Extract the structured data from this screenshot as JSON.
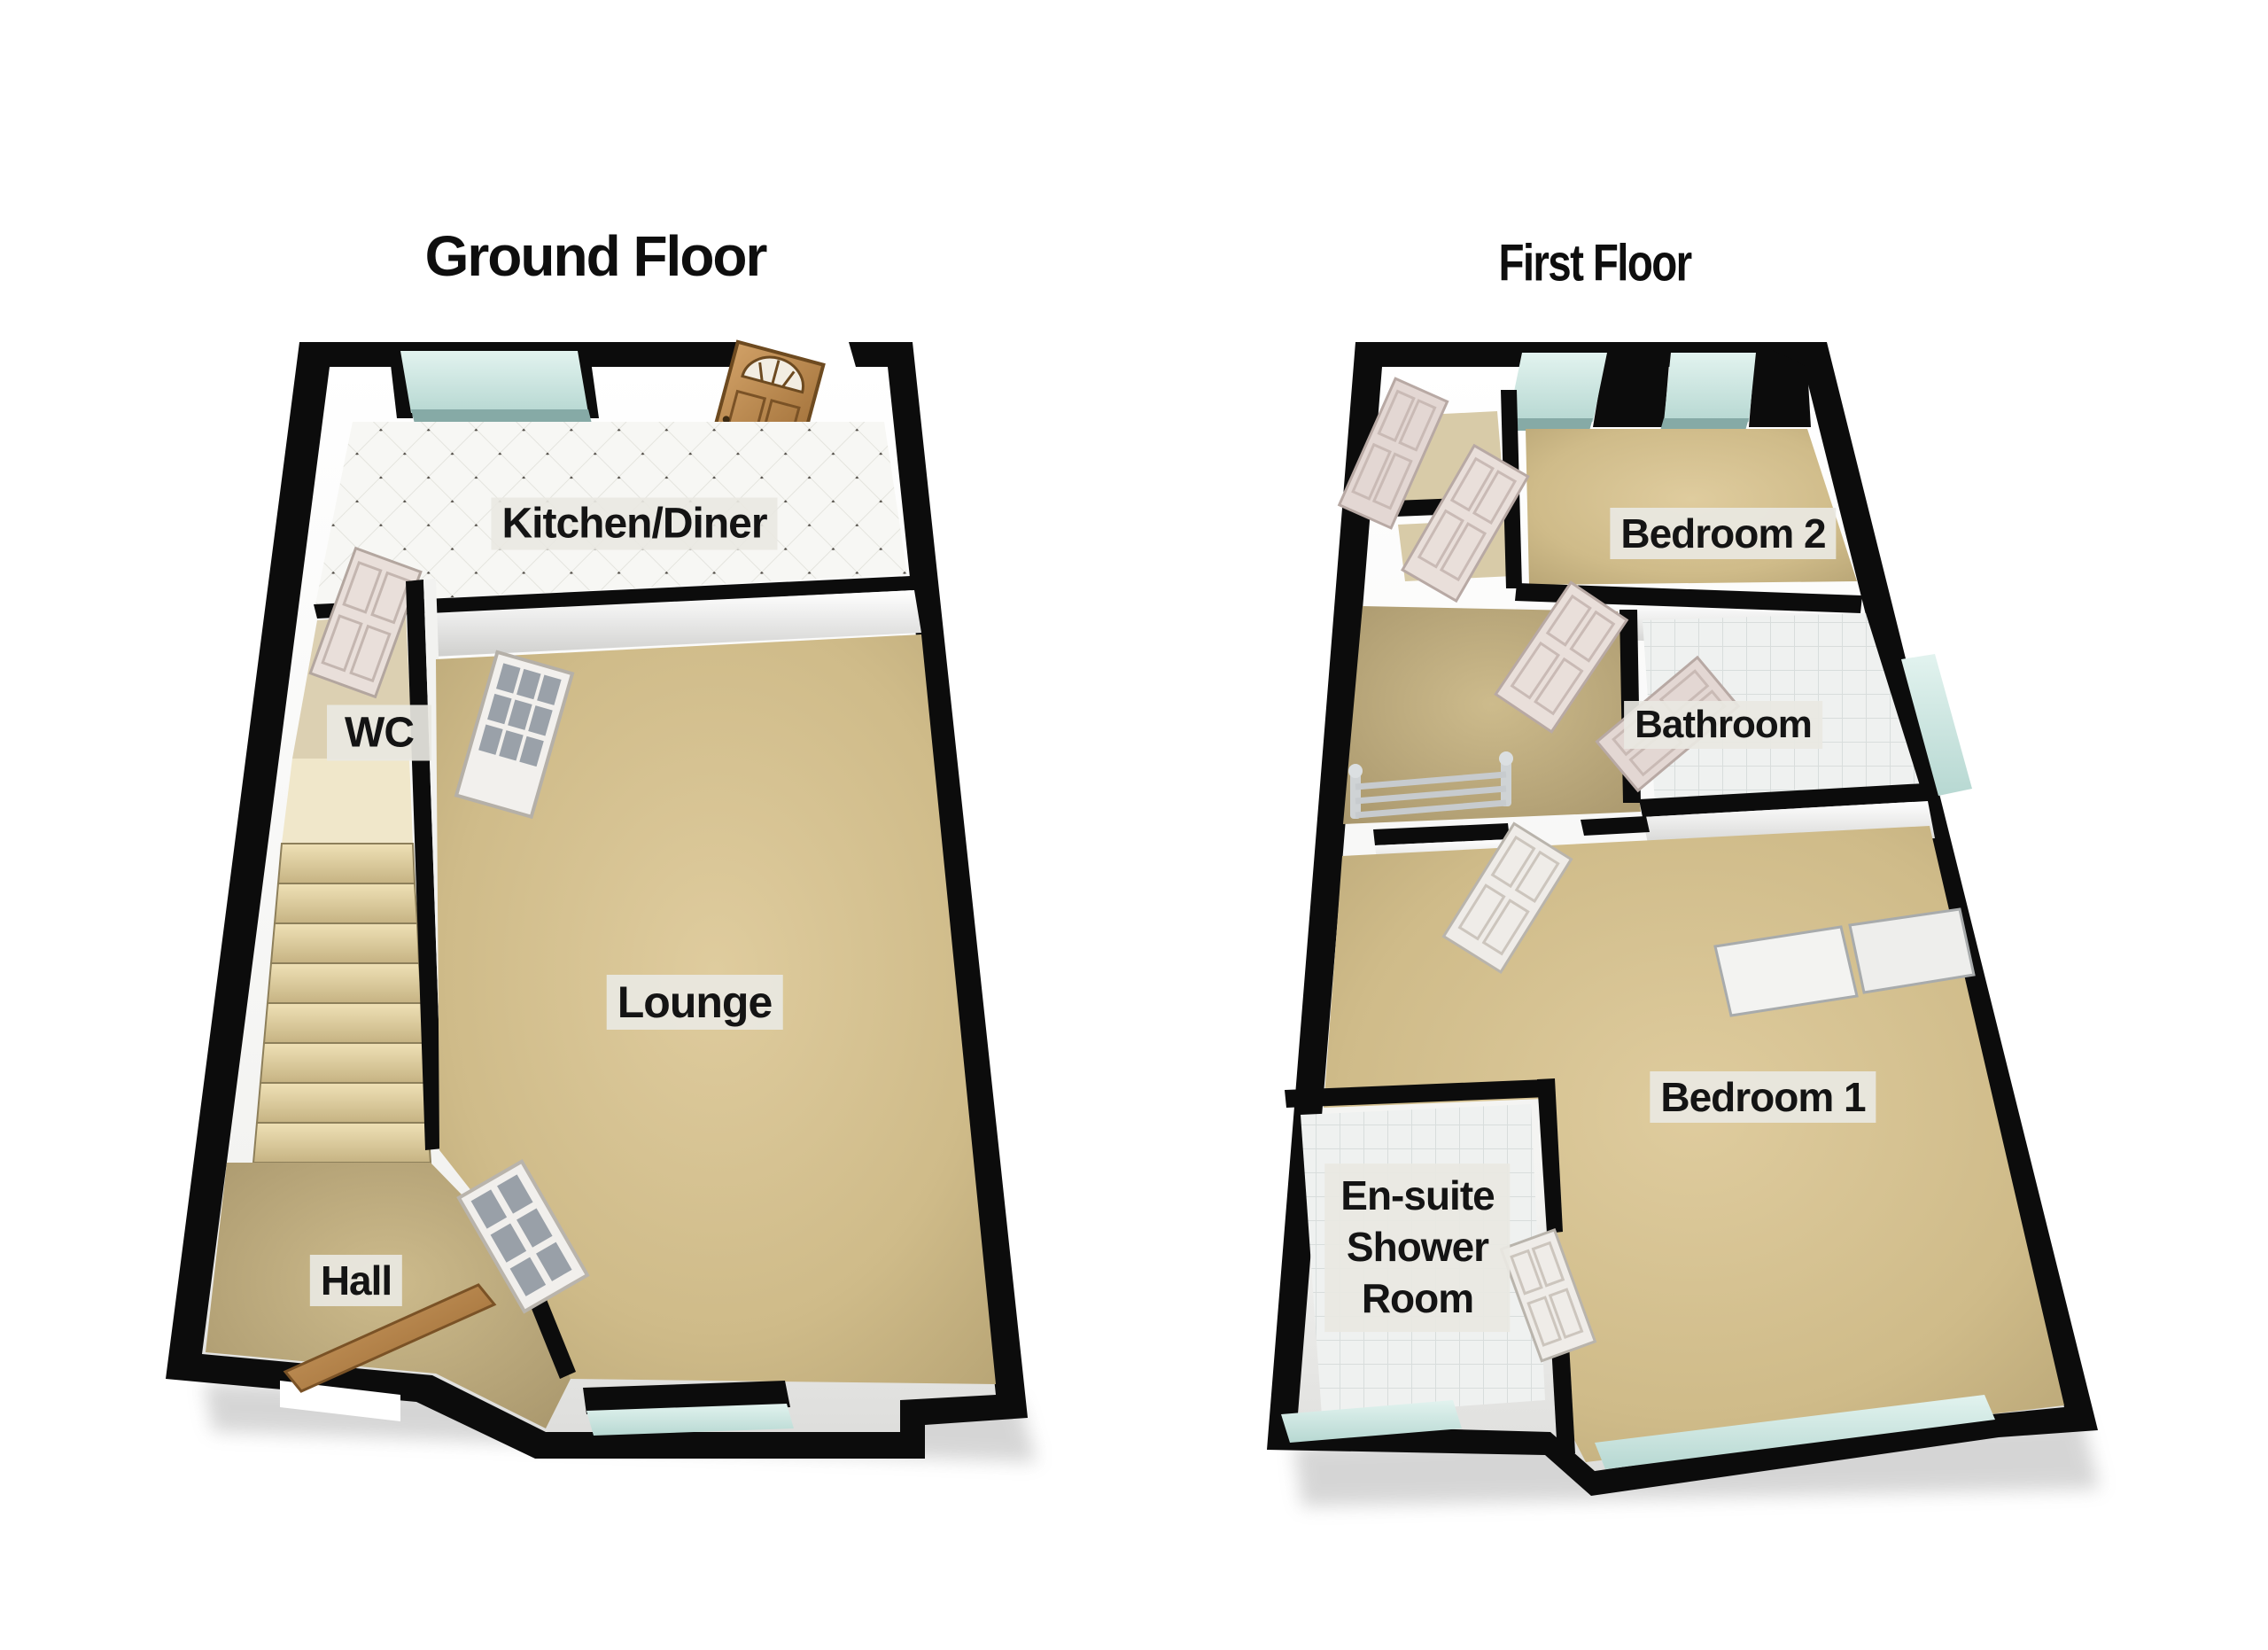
{
  "figure": {
    "type": "3d-floorplan",
    "background": "#ffffff"
  },
  "floors": [
    {
      "id": "ground-floor",
      "title": "Ground Floor",
      "rooms": [
        {
          "id": "kitchen-diner",
          "label": "Kitchen/Diner",
          "floor_finish": "white-tile"
        },
        {
          "id": "wc",
          "label": "WC",
          "floor_finish": "carpet"
        },
        {
          "id": "lounge",
          "label": "Lounge",
          "floor_finish": "carpet"
        },
        {
          "id": "hall",
          "label": "Hall",
          "floor_finish": "carpet"
        }
      ],
      "features": [
        "front-door",
        "staircase",
        "kitchen-window",
        "lounge-rear-window",
        "glazed-internal-doors",
        "wc-door",
        "entrance-door-leaning"
      ]
    },
    {
      "id": "first-floor",
      "title": "First Floor",
      "rooms": [
        {
          "id": "bedroom-2",
          "label": "Bedroom 2",
          "floor_finish": "carpet"
        },
        {
          "id": "bathroom",
          "label": "Bathroom",
          "floor_finish": "white-tile"
        },
        {
          "id": "bedroom-1",
          "label": "Bedroom 1",
          "floor_finish": "carpet"
        },
        {
          "id": "en-suite-shower-room",
          "label": "En-suite Shower Room",
          "label_lines": [
            "En-suite",
            "Shower",
            "Room"
          ],
          "floor_finish": "white-tile"
        }
      ],
      "features": [
        "stair-banister",
        "built-in-wardrobe",
        "two-front-windows",
        "bathroom-side-window",
        "rear-windows",
        "cupboard-doors"
      ]
    }
  ],
  "colors": {
    "wall_outline": "#0c0c0c",
    "wall_face": "#f5f5f3",
    "carpet": "#d3c08f",
    "tile": "#f1f3f2",
    "window_glass": "#cfe9e5",
    "wood_door": "#b9854c",
    "internal_door": "#e9dfda",
    "stairs": "#e6d7ab",
    "label_background": "#e9e8e2",
    "label_text": "#141414"
  }
}
